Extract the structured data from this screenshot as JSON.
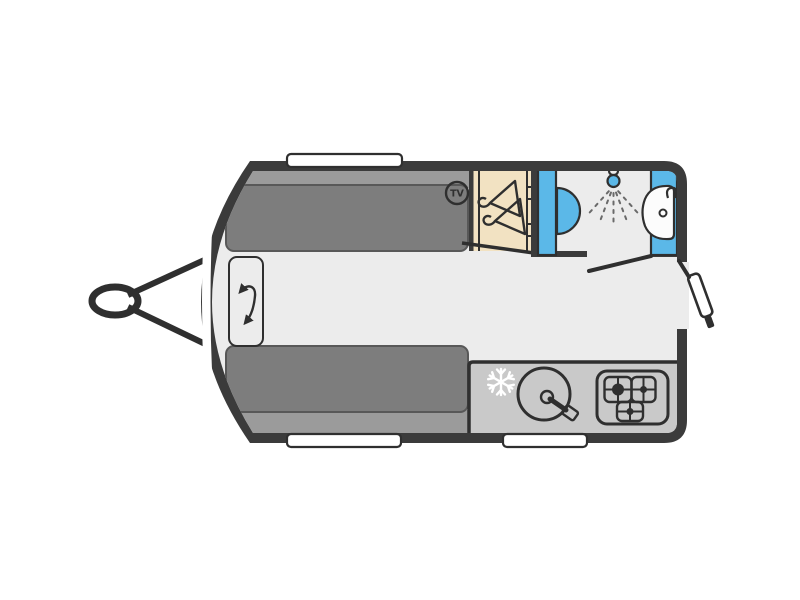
{
  "diagram": {
    "type": "caravan-floorplan-top-view",
    "labels": {
      "tv_badge": "TV"
    },
    "colors": {
      "background": "#FFFFFF",
      "wall": "#3B3B3B",
      "line": "#2F2F2F",
      "floor": "#ECECEC",
      "seat": "#7D7D7D",
      "seat_back": "#9B9B9B",
      "counter": "#C9C9C9",
      "wood": "#F2E2C2",
      "water_blue": "#5BB8E8",
      "hob_base": "#DEDEDE",
      "sink_bowl": "#F0F0F0"
    },
    "rooms": [
      "front-lounge",
      "wardrobe",
      "washroom",
      "kitchen"
    ],
    "features": [
      "tow-hitch",
      "front-window",
      "roof-window",
      "side-windows",
      "dinette-seat-top",
      "dinette-seat-bottom",
      "swivel-table",
      "tv-point",
      "wardrobe-hangers",
      "toilet",
      "shower",
      "washbasin",
      "washroom-door",
      "entry-door",
      "fridge",
      "kitchen-sink",
      "hob"
    ]
  }
}
